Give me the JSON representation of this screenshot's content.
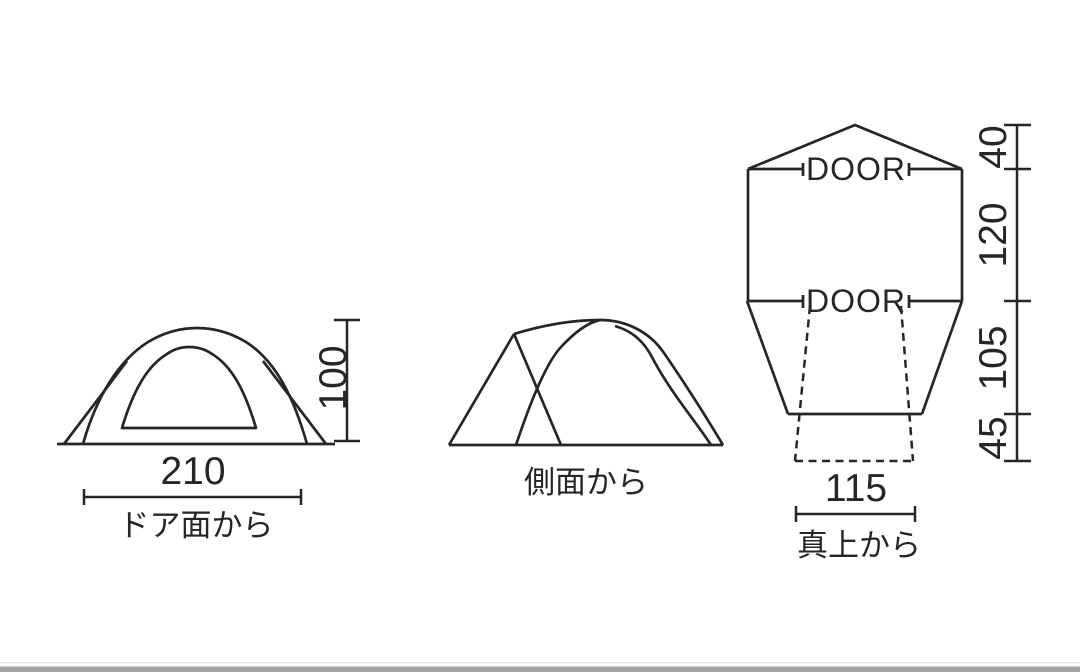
{
  "views": {
    "front": {
      "caption": "ドア面から",
      "width_value": "210",
      "height_value": "100"
    },
    "side": {
      "caption": "側面から"
    },
    "top": {
      "caption": "真上から",
      "width_value": "115",
      "door_top_label": "DOOR",
      "door_bottom_label": "DOOR",
      "segment_roof_value": "40",
      "segment_body_value": "120",
      "segment_lower_value": "105",
      "segment_flap_value": "45"
    }
  },
  "colors": {
    "line": "#262626",
    "background": "#ffffff",
    "bottom_bar": "#a6a3a3"
  }
}
